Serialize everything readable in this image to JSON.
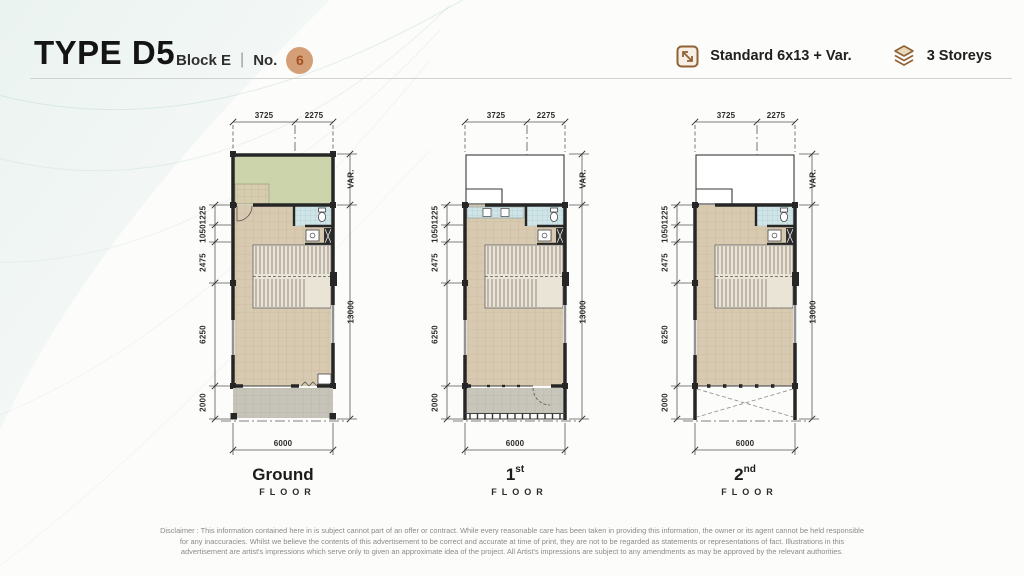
{
  "header": {
    "title": "TYPE D5",
    "block_label": "Block E",
    "divider": "|",
    "no_label": "No.",
    "unit_number": "6",
    "spec_label": "Standard 6x13 + Var.",
    "storeys_label": "3 Storeys"
  },
  "dimensions": {
    "top": [
      "3725",
      "2275"
    ],
    "left": [
      "1225",
      "1050",
      "2475",
      "6250",
      "2000"
    ],
    "right_var": "VAR.",
    "right_total": "13000",
    "bottom": "6000"
  },
  "plans": [
    {
      "id": "ground",
      "label": "Ground",
      "sup": "",
      "floor_word": "FLOOR",
      "top_section": "garden",
      "bottom_section": "driveway",
      "kitchen": false,
      "entry_door": true
    },
    {
      "id": "first",
      "label": "1",
      "sup": "st",
      "floor_word": "FLOOR",
      "top_section": "void",
      "bottom_section": "balcony",
      "kitchen": true,
      "entry_door": false
    },
    {
      "id": "second",
      "label": "2",
      "sup": "nd",
      "floor_word": "FLOOR",
      "top_section": "void",
      "bottom_section": "void",
      "kitchen": false,
      "entry_door": false
    }
  ],
  "colors": {
    "accent_bronze": "#8f6134",
    "unit_circle_bg": "#d49f76",
    "unit_circle_text": "#a24f22",
    "wall": "#262626",
    "garden": "#cbd4aa",
    "deck": "#d6ccae",
    "interior": "#d8cab1",
    "tile_blue": "#cfe4e6",
    "driveway": "#c6c3b9",
    "balcony": "#c8c5bb",
    "stair": "#eae4d7"
  },
  "disclaimer": [
    "Disclaimer : This information contained here in is subject cannot part of an offer or contract. While every reasonable care has been taken in providing this information, the owner or its agent cannot be held responsible",
    "for any inaccuracies. Whilst we believe the contents of this advertisement to be correct and accurate at time of print, they are not to be regarded as statements or representations of fact. Illustrations in this",
    "advertisement are artist's impressions which serve only to given an approximate idea of the project. All Artist's impressions are subject to any amendments as may be approved by the relevant authorities."
  ]
}
